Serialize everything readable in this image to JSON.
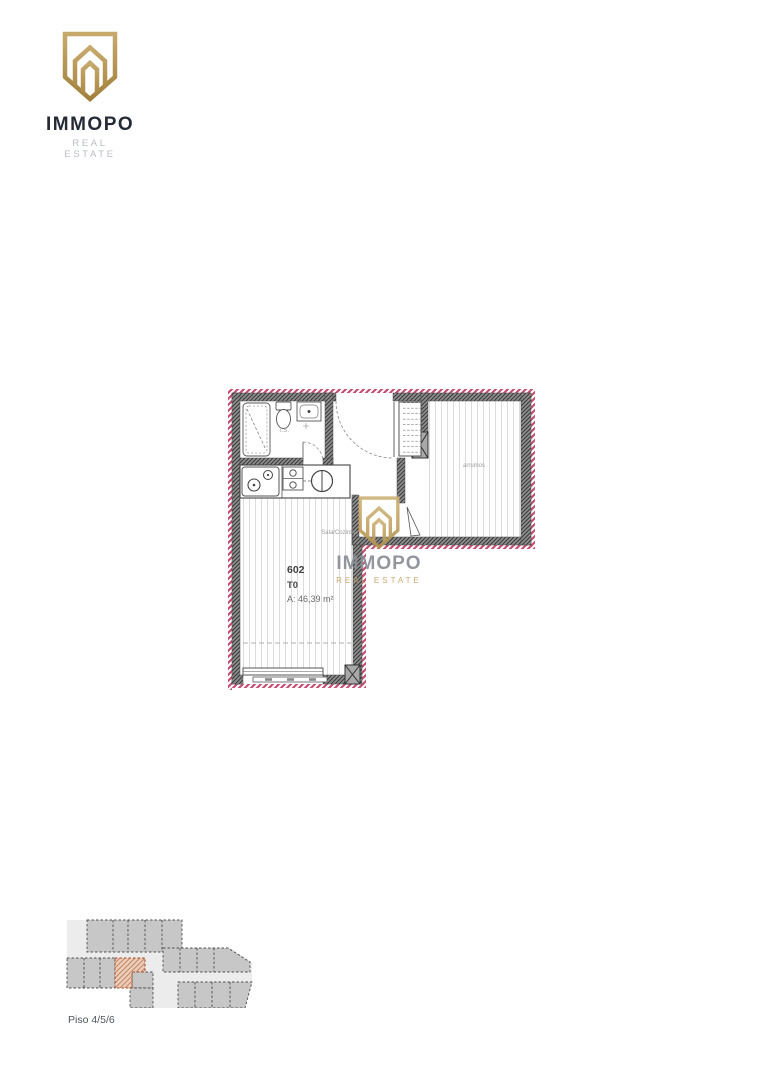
{
  "logo": {
    "brand": "IMMOPO",
    "tagline": "REAL ESTATE"
  },
  "watermark": {
    "brand": "IMMOPO",
    "tagline": "REAL ESTATE"
  },
  "plan": {
    "unit_number": "602",
    "typology": "T0",
    "area": "A: 46,39 m²",
    "labels": {
      "bathroom": "I.S.",
      "living_kitchen": "Sala/Cozinha",
      "storage": "arrumos"
    }
  },
  "keyplan": {
    "caption": "Piso 4/5/6"
  },
  "colors": {
    "brand_gold": "#b2914e",
    "logo_text": "#242b37",
    "logo_tagline": "#b9bdc4",
    "watermark_text": "#8a8e96",
    "watermark_tagline": "#c2a36b",
    "exterior_hatch_pink": "#c44f72",
    "wall_gray": "#8e8e8e",
    "keyplan_unit_fill": "#c7c7c7",
    "keyplan_highlight": "#edcdbc"
  }
}
